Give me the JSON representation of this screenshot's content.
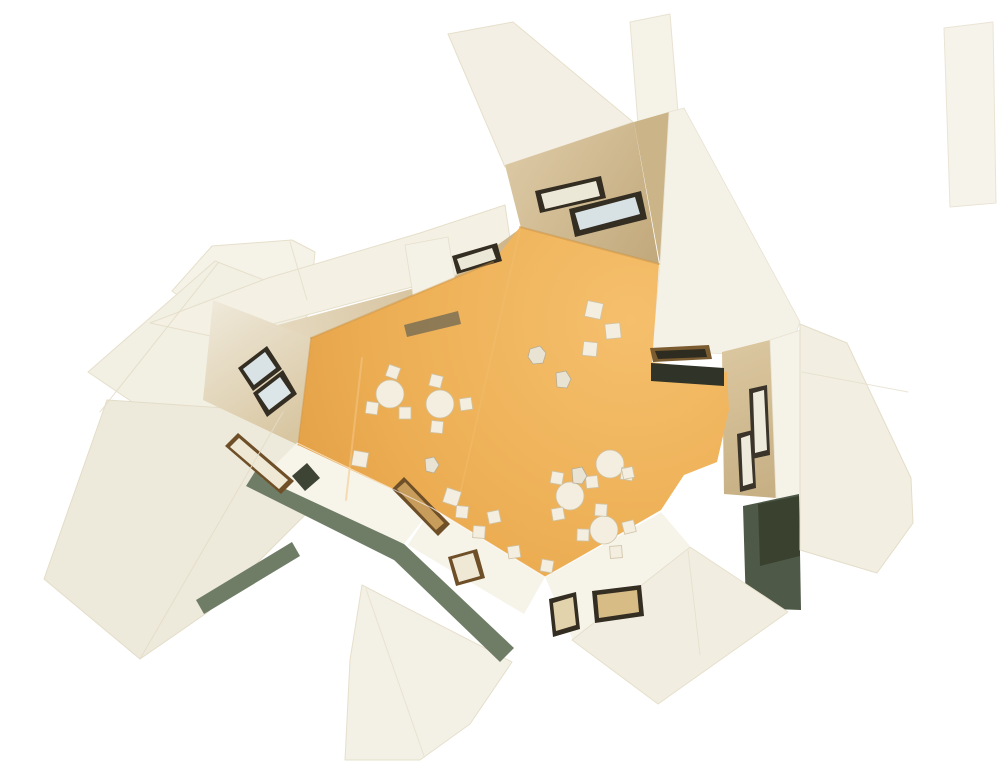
{
  "image": {
    "kind": "photograph-of-architectural-model",
    "description": "Top-down aerial photograph of a white cardboard architecture model: outward-splayed white wall panels with cut window openings surround an irregular zig-zag orange floor furnished with miniature round tables, square tables and chairs, and tiny human figures.",
    "width": 1000,
    "height": 764
  },
  "scene": {
    "background": "#ffffff",
    "palette": {
      "floor_orange": "#EDAF55",
      "panel_white": "#F3F0E5",
      "panel_cream": "#EEEADB",
      "wall_tan": "#CBB488",
      "olive_edge": "#6F7D66",
      "window_frame_dark": "#332D22",
      "window_frame_brown": "#6E4F28",
      "glass_blue": "#D9E3E6",
      "glass_cream": "#ECE8D8",
      "doorway_dark": "#2F3328",
      "furniture_cream": "#F3EEDF"
    },
    "gradients": [
      {
        "id": "g-floor",
        "type": "radial",
        "cx": 630,
        "cy": 320,
        "r": 430,
        "stops": [
          [
            0,
            "#F5BF6C"
          ],
          [
            0.55,
            "#EDAF55"
          ],
          [
            1,
            "#E19B41"
          ]
        ]
      },
      {
        "id": "g-ulband",
        "type": "linear",
        "x1": 230,
        "y1": 330,
        "x2": 515,
        "y2": 235,
        "stops": [
          [
            0,
            "#E9DFC8"
          ],
          [
            1,
            "#CDB58A"
          ]
        ]
      },
      {
        "id": "g-spike",
        "type": "linear",
        "x1": 505,
        "y1": 165,
        "x2": 655,
        "y2": 260,
        "stops": [
          [
            0,
            "#DBC8A3"
          ],
          [
            1,
            "#C2A97C"
          ]
        ]
      },
      {
        "id": "g-leftwall",
        "type": "linear",
        "x1": 213,
        "y1": 300,
        "x2": 300,
        "y2": 430,
        "stops": [
          [
            0,
            "#EFE9DA"
          ],
          [
            1,
            "#D8C6A1"
          ]
        ]
      },
      {
        "id": "g-rband",
        "type": "linear",
        "x1": 722,
        "y1": 352,
        "x2": 780,
        "y2": 500,
        "stops": [
          [
            0,
            "#DAC69F"
          ],
          [
            1,
            "#C6AE82"
          ]
        ]
      }
    ],
    "shapes": [
      {
        "name": "left-top-block",
        "pts": "172,291 212,246 292,240 315,252 310,304 225,330",
        "fill": "#F5F2E8",
        "stroke": "#E6DFCB",
        "sw": 1
      },
      {
        "name": "left-upper-wedge-panel",
        "pts": "215,261 318,301 206,452 88,372",
        "fill": "#F2EFE3",
        "stroke": "#E6DFCB",
        "sw": 1
      },
      {
        "name": "left-lower-wedge-panel",
        "pts": "107,400 283,412 350,470 208,612 140,659 44,579",
        "fill": "#EEEADB",
        "stroke": "#E3DCC8",
        "sw": 1
      },
      {
        "name": "olive-edge-left",
        "pts": "256,470 404,544 394,560 246,486",
        "fill": "#6F7D66"
      },
      {
        "name": "olive-edge-left-tail",
        "pts": "196,600 292,542 300,556 204,614",
        "fill": "#6F7D66"
      },
      {
        "name": "bottom-center-wedge-panel",
        "pts": "362,585 512,662 470,724 420,760 345,760 350,660",
        "fill": "#F3F0E5",
        "stroke": "#E6DFCB",
        "sw": 1
      },
      {
        "name": "olive-edge-center",
        "pts": "404,544 514,648 500,662 392,558",
        "fill": "#6F7D66"
      },
      {
        "name": "spike-outer-face",
        "pts": "448,34 513,22 633,122 505,167",
        "fill": "#F3EFE4",
        "stroke": "#E6DFCB",
        "sw": 1
      },
      {
        "name": "spike-top-nub",
        "pts": "630,22 670,14 678,112 638,124",
        "fill": "#F5F2E7",
        "stroke": "#E8E2D2",
        "sw": 1
      },
      {
        "name": "upperleft-band-outer",
        "pts": "150,323 268,278 420,233 505,205 512,252 450,277 220,338",
        "fill": "#F4F0E3",
        "stroke": "#E6DFCB",
        "sw": 1
      },
      {
        "name": "upperleft-band-inner",
        "pts": "222,340 452,278 521,228 493,262 311,338",
        "fill": "url(#g-ulband)"
      },
      {
        "name": "chimney-tab",
        "pts": "405,245 448,237 458,298 415,308",
        "fill": "#F4F1E6",
        "stroke": "#E6DFCB",
        "sw": 0.8
      },
      {
        "name": "spike-inner-face",
        "pts": "505,165 634,122 659,264 521,228",
        "fill": "url(#g-spike)"
      },
      {
        "name": "topright-wall-strip",
        "pts": "634,122 669,112 706,316 660,264",
        "fill": "#CBB488"
      },
      {
        "name": "topright-step-band",
        "pts": "660,264 669,112 684,108 800,322 792,344 728,354 652,350",
        "fill": "#F4F1E6",
        "stroke": "#E8E2D2",
        "sw": 0.8
      },
      {
        "name": "left-corner-wall",
        "pts": "213,300 311,338 298,445 203,400",
        "fill": "url(#g-leftwall)"
      },
      {
        "name": "lowerleft-wall-band",
        "pts": "297,443 432,508 404,544 262,478",
        "fill": "#F7F4EA"
      },
      {
        "name": "bottomleft-wall-band",
        "pts": "432,508 545,577 524,614 408,545",
        "fill": "#F6F3E9"
      },
      {
        "name": "bottomright-wall-band",
        "pts": "545,577 661,512 690,546 573,640",
        "fill": "#F6F3E9"
      },
      {
        "name": "right-wall-band-inner",
        "pts": "722,352 770,340 776,498 724,494",
        "fill": "url(#g-rband)"
      },
      {
        "name": "right-wall-band-outer",
        "pts": "770,340 801,330 808,506 776,498",
        "fill": "#F5F2E8",
        "stroke": "#E8E2D2",
        "sw": 0.8
      },
      {
        "name": "right-doorway",
        "pts": "743,506 799,494 801,610 746,608",
        "fill": "#4F5948"
      },
      {
        "name": "right-doorway-shade",
        "pts": "758,504 799,496 800,556 760,566",
        "fill": "#3A422F"
      },
      {
        "name": "bottomright-wedge-panel",
        "pts": "572,640 690,547 788,612 658,704",
        "fill": "#F1EDE0",
        "stroke": "#E6DFCB",
        "sw": 1
      },
      {
        "name": "right-outer-panel",
        "pts": "800,324 847,343 911,478 913,523 877,573 800,550",
        "fill": "#F2EEE1",
        "stroke": "#E4DDC9",
        "sw": 1
      },
      {
        "name": "topright-sliver-panel",
        "pts": "944,28 993,22 996,203 950,207",
        "fill": "#F6F3EA",
        "stroke": "#EAE4D5",
        "sw": 1
      },
      {
        "name": "floor",
        "pts": "311,338 493,262 520,227 659,264 652,362 727,372 729,410 717,462 684,475 661,510 545,577 432,508 298,445",
        "fill": "url(#g-floor)"
      },
      {
        "name": "floor-slot",
        "pts": "404,325 458,311 461,324 407,337",
        "fill": "#7D7055",
        "op": 0.85
      },
      {
        "name": "window-w3-frame",
        "pts": "452,256 497,243 502,261 457,274",
        "fill": "#332D22"
      },
      {
        "name": "window-w3-glass",
        "pts": "457,259 492,248 496,259 461,270",
        "fill": "#ECE8D8"
      },
      {
        "name": "window-b1-frame",
        "pts": "535,191 601,176 606,198 540,213",
        "fill": "#332D22"
      },
      {
        "name": "window-b1-glass",
        "pts": "541,194 596,181 600,196 545,209",
        "fill": "#ECE8D8"
      },
      {
        "name": "window-b2-frame",
        "pts": "569,209 641,191 647,219 575,237",
        "fill": "#332D22"
      },
      {
        "name": "window-b2-glass",
        "pts": "575,213 635,197 640,214 580,230",
        "fill": "#D8E2E4"
      },
      {
        "name": "window-w4a-frame",
        "pts": "238,368 267,346 282,369 253,391",
        "fill": "#332D22"
      },
      {
        "name": "window-w4a-glass",
        "pts": "243,369 265,352 276,368 254,385",
        "fill": "#D9E3E6"
      },
      {
        "name": "window-w4b-frame",
        "pts": "253,393 283,370 297,394 267,417",
        "fill": "#332D22"
      },
      {
        "name": "window-w4b-glass",
        "pts": "258,394 280,377 291,393 269,410",
        "fill": "#DCE5E7"
      },
      {
        "name": "window-f1-frame",
        "pts": "225,446 238,433 294,481 281,494",
        "fill": "#6E4F28"
      },
      {
        "name": "window-f1-glass",
        "pts": "230,447 239,438 288,480 279,489",
        "fill": "#EFE8D4"
      },
      {
        "name": "window-f2-dark",
        "pts": "292,476 307,463 320,478 305,491",
        "fill": "#3E4434"
      },
      {
        "name": "window-f3-frame",
        "pts": "392,489 404,477 450,524 438,536",
        "fill": "#6E4F28"
      },
      {
        "name": "window-f3-glass",
        "pts": "397,489 405,482 444,523 436,530",
        "fill": "#C89C5A"
      },
      {
        "name": "window-f7-frame",
        "pts": "448,557 477,549 485,578 456,586",
        "fill": "#6E4F28"
      },
      {
        "name": "window-f7-glass",
        "pts": "452,559 473,553 480,576 459,582",
        "fill": "#EFE8D4"
      },
      {
        "name": "window-f4-frame",
        "pts": "549,599 576,592 580,629 553,637",
        "fill": "#332D22"
      },
      {
        "name": "window-f4-glass",
        "pts": "553,603 573,597 576,625 556,631",
        "fill": "#E3D3AC"
      },
      {
        "name": "window-f5-frame",
        "pts": "592,591 641,585 644,616 595,623",
        "fill": "#332D22"
      },
      {
        "name": "window-f5-glass",
        "pts": "597,595 637,590 639,612 599,618",
        "fill": "#D8BC85"
      },
      {
        "name": "window-v1-frame",
        "pts": "749,389 767,385 770,455 752,459",
        "fill": "#3A342A"
      },
      {
        "name": "window-v1-glass",
        "pts": "753,393 764,390 767,450 755,453",
        "fill": "#EFEBDC"
      },
      {
        "name": "window-v2-frame",
        "pts": "737,434 753,430 756,488 740,492",
        "fill": "#3A342A"
      },
      {
        "name": "window-v2-glass",
        "pts": "741,438 750,435 753,483 743,486",
        "fill": "#EFEBDC"
      },
      {
        "name": "skylight-f6-frame",
        "pts": "650,348 709,345 712,359 653,362",
        "fill": "#7A5C30"
      },
      {
        "name": "skylight-f6-glass",
        "pts": "655,351 705,349 707,357 658,359",
        "fill": "#2E2B20"
      },
      {
        "name": "doorway-d2",
        "pts": "651,363 724,368 724,386 651,381",
        "fill": "#2F3328"
      }
    ],
    "lines": [
      {
        "name": "floor-seam-1",
        "x1": 362,
        "y1": 358,
        "x2": 346,
        "y2": 500,
        "stroke": "#F6C886",
        "w": 2,
        "op": 0.55
      },
      {
        "name": "floor-seam-2",
        "x1": 520,
        "y1": 230,
        "x2": 458,
        "y2": 503,
        "stroke": "#F3C176",
        "w": 1.5,
        "op": 0.4
      },
      {
        "name": "wall-base-shadow-upperleft",
        "x1": 311,
        "y1": 338,
        "x2": 493,
        "y2": 262,
        "stroke": "#C98F3E",
        "w": 2,
        "op": 0.45
      },
      {
        "name": "wall-base-shadow-top",
        "x1": 520,
        "y1": 227,
        "x2": 659,
        "y2": 264,
        "stroke": "#C98F3E",
        "w": 2,
        "op": 0.45
      },
      {
        "name": "wall-base-shadow-left",
        "x1": 298,
        "y1": 445,
        "x2": 311,
        "y2": 338,
        "stroke": "#C98F3E",
        "w": 1.5,
        "op": 0.4
      },
      {
        "name": "fold-left-lower-wedge",
        "x1": 283,
        "y1": 412,
        "x2": 140,
        "y2": 659,
        "stroke": "#E3DCC8",
        "w": 1,
        "op": 0.9
      },
      {
        "name": "fold-left-upper-wedge",
        "x1": 218,
        "y1": 263,
        "x2": 100,
        "y2": 412,
        "stroke": "#E3DCC8",
        "w": 1,
        "op": 0.9
      },
      {
        "name": "fold-left-top-block",
        "x1": 290,
        "y1": 242,
        "x2": 307,
        "y2": 300,
        "stroke": "#E6DFCB",
        "w": 1,
        "op": 0.9
      },
      {
        "name": "fold-bottom-wedge",
        "x1": 366,
        "y1": 589,
        "x2": 424,
        "y2": 756,
        "stroke": "#E6DFCC",
        "w": 1,
        "op": 0.8
      },
      {
        "name": "fold-bottomright-wedge",
        "x1": 688,
        "y1": 550,
        "x2": 700,
        "y2": 655,
        "stroke": "#E6DFCC",
        "w": 1,
        "op": 0.8
      },
      {
        "name": "fold-right-outer-panel",
        "x1": 802,
        "y1": 372,
        "x2": 908,
        "y2": 392,
        "stroke": "#E6DFCC",
        "w": 1,
        "op": 0.8
      },
      {
        "name": "wall-top-highlight-br",
        "x1": 545,
        "y1": 577,
        "x2": 661,
        "y2": 512,
        "stroke": "#FFFFFF",
        "w": 1.2,
        "op": 0.7
      },
      {
        "name": "wall-top-highlight-bl",
        "x1": 432,
        "y1": 508,
        "x2": 545,
        "y2": 577,
        "stroke": "#FFFFFF",
        "w": 1.2,
        "op": 0.7
      },
      {
        "name": "wall-top-highlight-ll",
        "x1": 297,
        "y1": 443,
        "x2": 432,
        "y2": 508,
        "stroke": "#FFFFFF",
        "w": 1,
        "op": 0.6
      }
    ],
    "furniture": {
      "table_fill": "#F3EEDF",
      "table_stroke": "#CFC2A4",
      "round_tables": [
        {
          "x": 390,
          "y": 394,
          "r": 14
        },
        {
          "x": 440,
          "y": 404,
          "r": 14
        },
        {
          "x": 610,
          "y": 464,
          "r": 14
        },
        {
          "x": 570,
          "y": 496,
          "r": 14
        },
        {
          "x": 604,
          "y": 530,
          "r": 14
        }
      ],
      "square_items": [
        {
          "x": 393,
          "y": 372,
          "s": 12,
          "rot": 20
        },
        {
          "x": 372,
          "y": 408,
          "s": 12,
          "rot": 8
        },
        {
          "x": 405,
          "y": 413,
          "s": 12,
          "rot": 0
        },
        {
          "x": 436,
          "y": 381,
          "s": 12,
          "rot": 14
        },
        {
          "x": 466,
          "y": 404,
          "s": 12,
          "rot": -8
        },
        {
          "x": 437,
          "y": 427,
          "s": 12,
          "rot": 6
        },
        {
          "x": 594,
          "y": 310,
          "s": 16,
          "rot": 12
        },
        {
          "x": 590,
          "y": 349,
          "s": 14,
          "rot": 6
        },
        {
          "x": 613,
          "y": 331,
          "s": 15,
          "rot": -6
        },
        {
          "x": 360,
          "y": 459,
          "s": 15,
          "rot": 10
        },
        {
          "x": 452,
          "y": 497,
          "s": 15,
          "rot": 18
        },
        {
          "x": 557,
          "y": 478,
          "s": 12,
          "rot": 10
        },
        {
          "x": 592,
          "y": 482,
          "s": 12,
          "rot": -6
        },
        {
          "x": 627,
          "y": 474,
          "s": 12,
          "rot": 8
        },
        {
          "x": 558,
          "y": 514,
          "s": 12,
          "rot": -10
        },
        {
          "x": 601,
          "y": 510,
          "s": 12,
          "rot": 4
        },
        {
          "x": 629,
          "y": 527,
          "s": 12,
          "rot": -14
        },
        {
          "x": 583,
          "y": 535,
          "s": 12,
          "rot": 2
        },
        {
          "x": 616,
          "y": 552,
          "s": 12,
          "rot": -4
        },
        {
          "x": 547,
          "y": 566,
          "s": 12,
          "rot": 10
        },
        {
          "x": 514,
          "y": 552,
          "s": 12,
          "rot": -8
        },
        {
          "x": 462,
          "y": 512,
          "s": 12,
          "rot": 6
        },
        {
          "x": 494,
          "y": 517,
          "s": 12,
          "rot": -12
        },
        {
          "x": 479,
          "y": 532,
          "s": 12,
          "rot": 4
        },
        {
          "x": 628,
          "y": 473,
          "s": 11,
          "rot": -12
        }
      ]
    },
    "figures": {
      "fill": "#E9E3D3",
      "stroke": "#B7AC93",
      "blobs": [
        {
          "name": "figure-1",
          "pts": "530,349 540,346 546,353 543,363 533,364 528,357"
        },
        {
          "name": "figure-2",
          "pts": "556,373 566,371 571,379 567,388 557,387"
        },
        {
          "name": "figure-3",
          "pts": "572,469 582,467 587,476 582,484 573,483"
        },
        {
          "name": "figure-4",
          "pts": "425,459 434,457 439,465 434,473 426,471"
        }
      ]
    }
  }
}
